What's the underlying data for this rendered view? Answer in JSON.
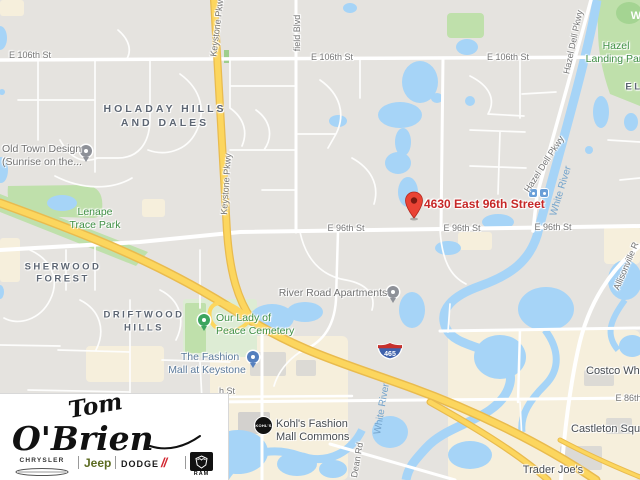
{
  "map": {
    "colors": {
      "background": "#e5e3df",
      "water": "#a6d4f7",
      "park": "#bfe0ab",
      "commercial": "#f6efdc",
      "highway_fill": "#fcd65e",
      "highway_casing": "#e9bb4e",
      "road": "#ffffff",
      "destination_text": "#c62828",
      "destination_pin": "#ea4335"
    },
    "destination": {
      "label": "4630 East 96th Street"
    },
    "shield": {
      "i465": "465"
    },
    "streets": {
      "e106_a": "E 106th St",
      "e106_b": "E 106th St",
      "e106_c": "E 106th St",
      "e96_a": "E 96th St",
      "e96_b": "E 96th St",
      "e96_c": "E 96th St",
      "e86": "E 86th St",
      "h_st": "h St",
      "field_blvd": "field Blvd",
      "keystone_a": "Keystone Pkwy",
      "keystone_b": "Keystone Pkwy",
      "hazel_dell_a": "Hazel Dell Pkwy",
      "hazel_dell_b": "Hazel Dell Pkwy",
      "allisonville": "Allisonville R",
      "dean": "Dean Rd"
    },
    "water_labels": {
      "white_river_a": "White River",
      "white_river_b": "White River"
    },
    "areas": {
      "holaday_1": "HOLADAY HILLS",
      "holaday_2": "AND DALES",
      "sherwood_1": "SHERWOOD",
      "sherwood_2": "FOREST",
      "driftwood_1": "DRIFTWOOD",
      "driftwood_2": "HILLS",
      "el": "EL",
      "w": "W"
    },
    "parks": {
      "lenape_1": "Lenape",
      "lenape_2": "Trace Park",
      "hazel_landing_1": "Hazel",
      "hazel_landing_2": "Landing Par",
      "our_lady_1": "Our Lady of",
      "our_lady_2": "Peace Cemetery"
    },
    "pois": {
      "old_town_1": "Old Town Design",
      "old_town_2": "(Sunrise on the...",
      "river_road": "River Road Apartments",
      "fashion_1": "The Fashion",
      "fashion_2": "Mall at Keystone",
      "kohls_1": "Kohl's Fashion",
      "kohls_2": "Mall Commons",
      "kohls_badge": "KOHL'S",
      "trader_joes": "Trader Joe's",
      "costco": "Costco Wh",
      "castleton": "Castleton Squa"
    }
  },
  "logo": {
    "first_name": "Tom",
    "last_name": "O'Brien",
    "brands": {
      "chrysler": "CHRYSLER",
      "jeep": "Jeep",
      "dodge": "DODGE",
      "dodge_slashes": "//",
      "ram": "RAM"
    }
  }
}
